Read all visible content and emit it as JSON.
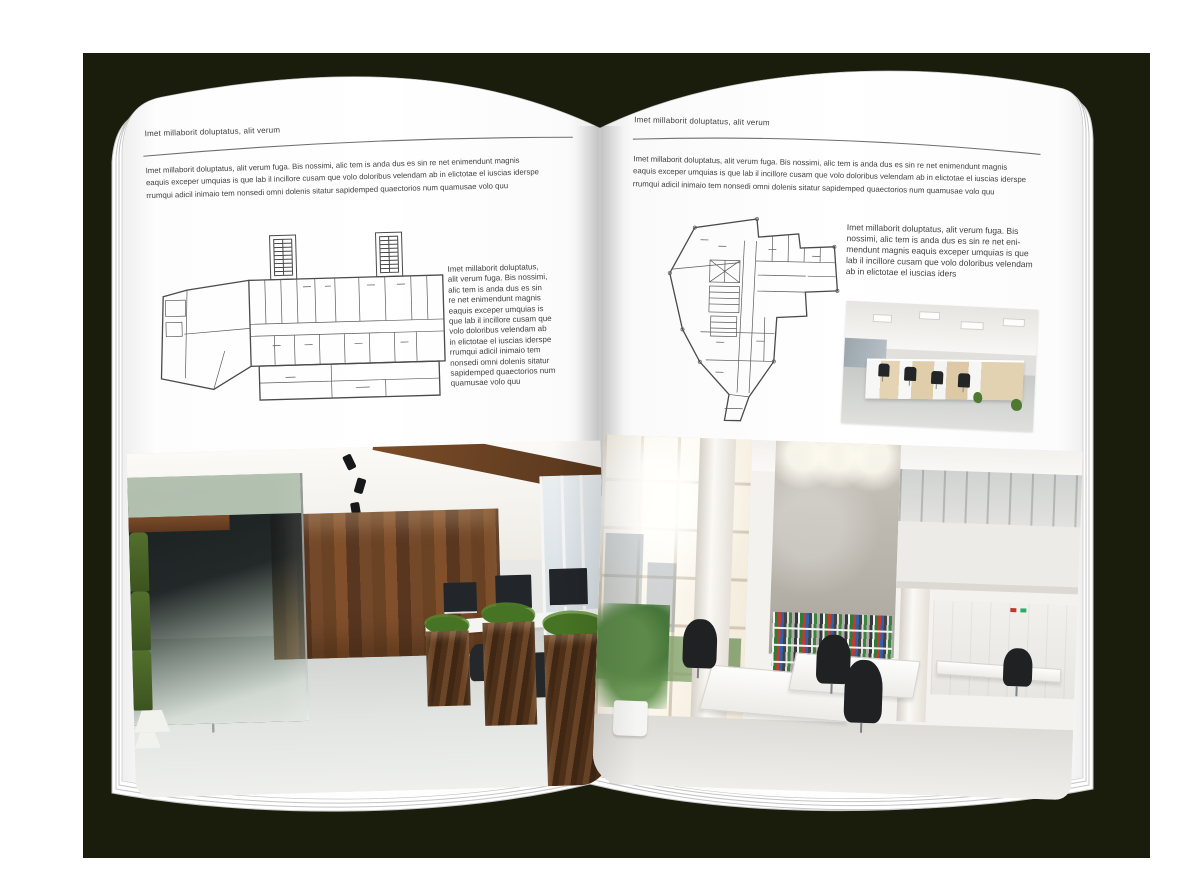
{
  "mockup": {
    "background_color": "#1b1d0c",
    "page_color": "#ffffff"
  },
  "left_page": {
    "header": "Imet millaborit doluptatus, alit verum",
    "intro": "Imet millaborit doluptatus, alit verum fuga. Bis nossimi, alic tem is anda dus es sin re net enimendunt magnis\neaquis exceper umquias is que lab il incillore cusam que volo doloribus velendam ab in elictotae el iuscias iderspe\nrrumqui adicil inimaio tem nonsedi omni dolenis sitatur sapidemped quaectorios num quamusae volo quu",
    "side_text": "Imet millaborit doluptatus,\nalit verum fuga. Bis nossimi,\nalic tem is anda dus es sin\nre net enimendunt magnis\neaquis exceper umquias is\nque lab il incillore cusam que\nvolo doloribus velendam ab\nin elictotae el iuscias iderspe\nrrumqui adicil inimaio tem\nnonsedi omni dolenis sitatur\nsapidemped quaectorios num\nquamusae volo quu",
    "floor_plan": "wide multi-room building floor plan with two stair towers",
    "photo": "dark loft office with glass meeting room, green chairs and wood panel wall"
  },
  "right_page": {
    "header": "Imet millaborit doluptatus, alit verum",
    "intro": "Imet millaborit doluptatus, alit verum fuga. Bis nossimi, alic tem is anda dus es sin re net enimendunt magnis\neaquis exceper umquias is que lab il incillore cusam que volo doloribus velendam ab in elictotae el iuscias iderspe\nrrumqui adicil inimaio tem nonsedi omni dolenis sitatur sapidemped quaectorios num quamusae volo quu",
    "side_text": "Imet millaborit doluptatus, alit verum fuga. Bis\nnossimi, alic tem is anda dus es sin re net eni-\nmendunt magnis eaquis exceper umquias is que\nlab il incillore cusam que volo doloribus velendam\nab in elictotae el iuscias iders",
    "floor_plan": "irregular angled-footprint floor plan with central core",
    "photo_small": "open plan office with light wood workstations and ceiling light panels",
    "photo_large": "bright double-height white office with tall sunny windows, binder shelves and mezzanine"
  }
}
